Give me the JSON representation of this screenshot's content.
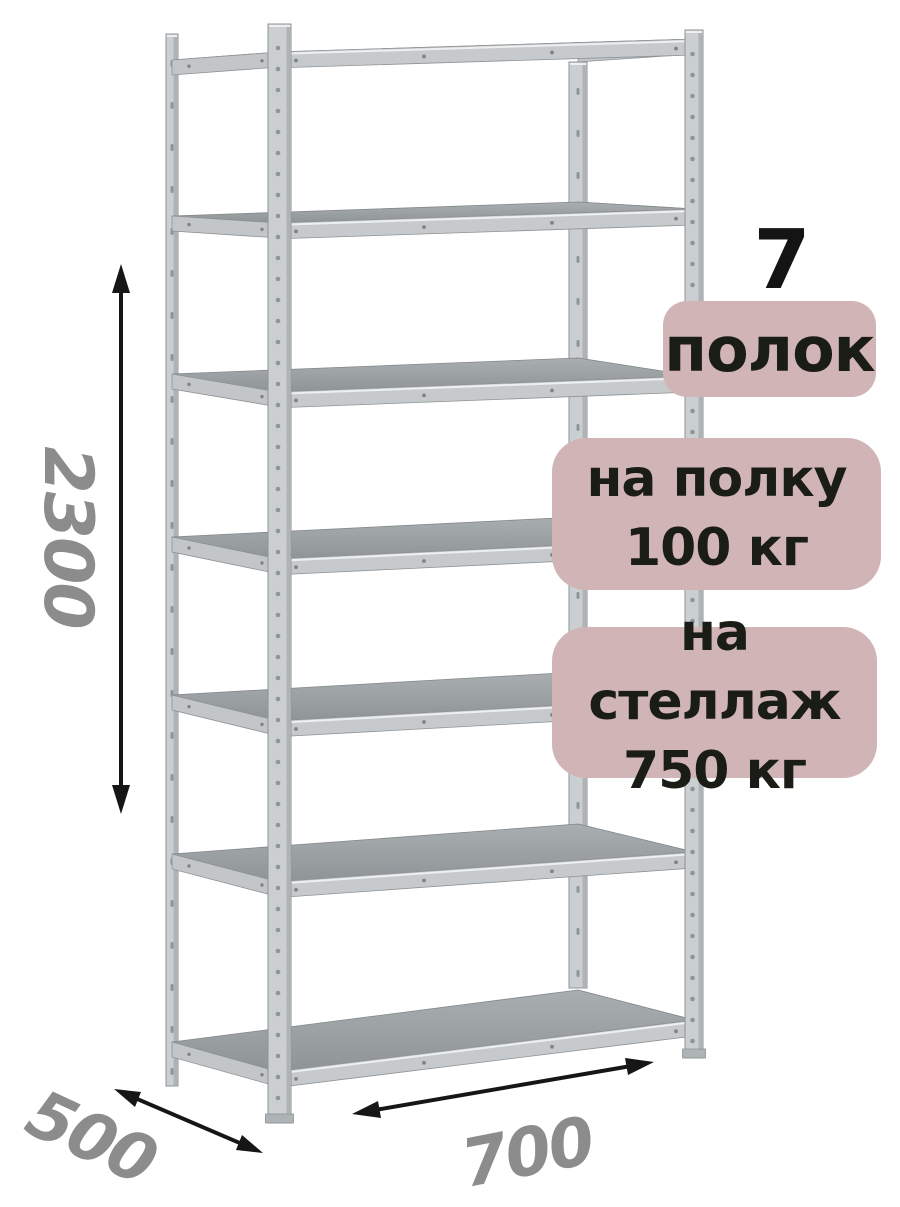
{
  "annotations": {
    "shelf_count_number": "7",
    "shelf_count_label": "полок",
    "per_shelf": {
      "label": "на полку",
      "value": "100 кг"
    },
    "per_rack": {
      "label": "на стеллаж",
      "value": "750 кг"
    }
  },
  "dimensions": {
    "height": "2300",
    "depth": "500",
    "width": "700"
  },
  "colors": {
    "background": "#ffffff",
    "badge_bg": "#d1b4b5",
    "badge_text": "#1a1d15",
    "count_text": "#141414",
    "dim_text": "#8c8c8c",
    "arrow": "#161616",
    "frame_light": "#cbcfd2",
    "frame_mid": "#c2c6c9",
    "frame_beam": "#c6cacd",
    "frame_shade": "#aeb3b6",
    "frame_edge": "#8e9396",
    "frame_highlight": "#edeff0",
    "perforation": "#8f9598",
    "shelf_surface_light": "#a9aeb1",
    "shelf_surface_dark": "#8f9497",
    "screw": "#7e8386"
  }
}
